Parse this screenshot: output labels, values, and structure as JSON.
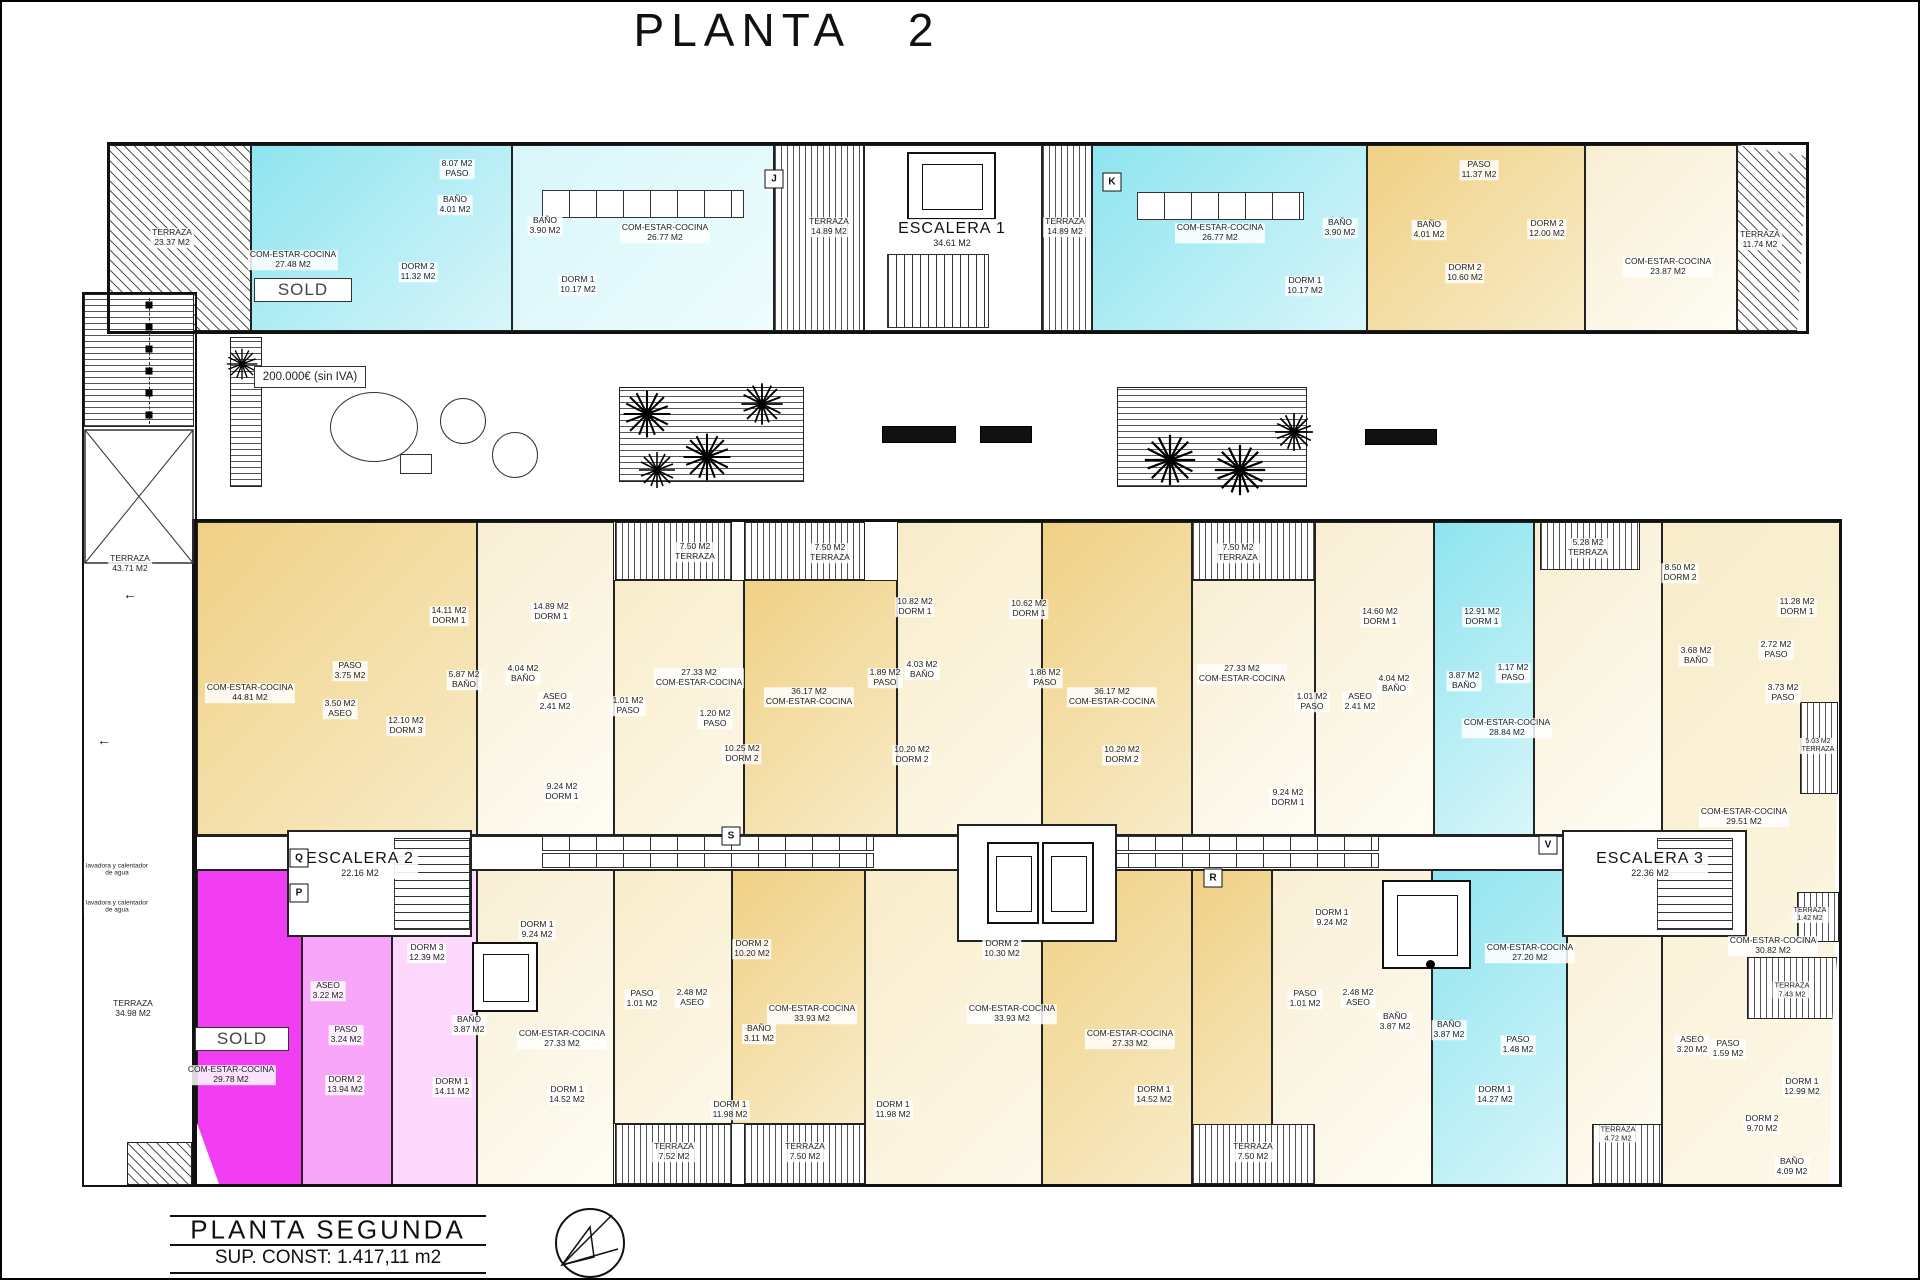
{
  "title": "PLANTA   2",
  "price": "200.000€ (sin IVA)",
  "sold": "SOLD",
  "footer": {
    "name": "PLANTA SEGUNDA",
    "sup": "SUP. CONST: 1.417,11 m2"
  },
  "colors": {
    "cyan": "#8ee4ef",
    "cyanLight": "#d8f6fa",
    "yellow": "#f0d084",
    "yellowLight": "#f8ecc9",
    "magenta": "#f23ef2",
    "pink": "#f8a6f8",
    "pinkLight": "#fcd9fc",
    "wall": "#111111",
    "hatch": "#555555"
  },
  "stairs": [
    {
      "name": "ESCALERA 1",
      "area": "34.61 M2",
      "x": 950,
      "y": 232
    },
    {
      "name": "ESCALERA 2",
      "area": "22.16 M2",
      "x": 358,
      "y": 862
    },
    {
      "name": "ESCALERA 3",
      "area": "22.36 M2",
      "x": 1648,
      "y": 862
    }
  ],
  "markers": [
    {
      "t": "J",
      "x": 772,
      "y": 177
    },
    {
      "t": "K",
      "x": 1110,
      "y": 180
    },
    {
      "t": "Q",
      "x": 297,
      "y": 856
    },
    {
      "t": "P",
      "x": 297,
      "y": 891
    },
    {
      "t": "S",
      "x": 729,
      "y": 834
    },
    {
      "t": "R",
      "x": 1211,
      "y": 876
    },
    {
      "t": "V",
      "x": 1546,
      "y": 843
    }
  ],
  "decor_glyphs": [
    {
      "t": "←",
      "x": 102,
      "y": 738
    },
    {
      "t": "←",
      "x": 128,
      "y": 592
    }
  ],
  "rooms": [
    {
      "lines": [
        "TERRAZA",
        "23.37 M2"
      ],
      "x": 170,
      "y": 236
    },
    {
      "lines": [
        "8.07 M2",
        "PASO"
      ],
      "x": 455,
      "y": 167
    },
    {
      "lines": [
        "BAÑO",
        "4.01 M2"
      ],
      "x": 453,
      "y": 203
    },
    {
      "lines": [
        "COM-ESTAR-COCINA",
        "27.48 M2"
      ],
      "x": 291,
      "y": 258
    },
    {
      "lines": [
        "DORM 2",
        "11.32 M2"
      ],
      "x": 416,
      "y": 270
    },
    {
      "lines": [
        "BAÑO",
        "3.90 M2"
      ],
      "x": 543,
      "y": 224
    },
    {
      "lines": [
        "DORM 1",
        "10.17 M2"
      ],
      "x": 576,
      "y": 283
    },
    {
      "lines": [
        "COM-ESTAR-COCINA",
        "26.77 M2"
      ],
      "x": 663,
      "y": 231
    },
    {
      "lines": [
        "TERRAZA",
        "14.89 M2"
      ],
      "x": 827,
      "y": 225
    },
    {
      "lines": [
        "TERRAZA",
        "14.89 M2"
      ],
      "x": 1063,
      "y": 225
    },
    {
      "lines": [
        "COM-ESTAR-COCINA",
        "26.77 M2"
      ],
      "x": 1218,
      "y": 231
    },
    {
      "lines": [
        "BAÑO",
        "3.90 M2"
      ],
      "x": 1338,
      "y": 226
    },
    {
      "lines": [
        "DORM 1",
        "10.17 M2"
      ],
      "x": 1303,
      "y": 284
    },
    {
      "lines": [
        "PASO",
        "11.37 M2"
      ],
      "x": 1477,
      "y": 168
    },
    {
      "lines": [
        "BAÑO",
        "4.01 M2"
      ],
      "x": 1427,
      "y": 228
    },
    {
      "lines": [
        "DORM 2",
        "10.60 M2"
      ],
      "x": 1463,
      "y": 271
    },
    {
      "lines": [
        "DORM 2",
        "12.00 M2"
      ],
      "x": 1545,
      "y": 227
    },
    {
      "lines": [
        "COM-ESTAR-COCINA",
        "23.87 M2"
      ],
      "x": 1666,
      "y": 265
    },
    {
      "lines": [
        "TERRAZA",
        "11.74 M2"
      ],
      "x": 1758,
      "y": 238
    },
    {
      "lines": [
        "TERRAZA",
        "43.71 M2"
      ],
      "x": 128,
      "y": 562
    },
    {
      "lines": [
        "lavadora y calentador",
        "de agua"
      ],
      "x": 115,
      "y": 868,
      "fs": 6.5
    },
    {
      "lines": [
        "lavadora y calentador",
        "de agua"
      ],
      "x": 115,
      "y": 905,
      "fs": 6.5
    },
    {
      "lines": [
        "TERRAZA",
        "34.98 M2"
      ],
      "x": 131,
      "y": 1007
    },
    {
      "lines": [
        "14.11 M2",
        "DORM 1"
      ],
      "x": 447,
      "y": 614
    },
    {
      "lines": [
        "14.89 M2",
        "DORM 1"
      ],
      "x": 549,
      "y": 610
    },
    {
      "lines": [
        "COM-ESTAR-COCINA",
        "44.81 M2"
      ],
      "x": 248,
      "y": 691
    },
    {
      "lines": [
        "PASO",
        "3.75 M2"
      ],
      "x": 348,
      "y": 669
    },
    {
      "lines": [
        "3.50 M2",
        "ASEO"
      ],
      "x": 338,
      "y": 707
    },
    {
      "lines": [
        "5.87 M2",
        "BAÑO"
      ],
      "x": 462,
      "y": 678
    },
    {
      "lines": [
        "12.10 M2",
        "DORM 3"
      ],
      "x": 404,
      "y": 724
    },
    {
      "lines": [
        "4.04 M2",
        "BAÑO"
      ],
      "x": 521,
      "y": 672
    },
    {
      "lines": [
        "ASEO",
        "2.41 M2"
      ],
      "x": 553,
      "y": 700
    },
    {
      "lines": [
        "1.01 M2",
        "PASO"
      ],
      "x": 626,
      "y": 704
    },
    {
      "lines": [
        "27.33 M2",
        "COM-ESTAR-COCINA"
      ],
      "x": 697,
      "y": 676
    },
    {
      "lines": [
        "7.50 M2",
        "TERRAZA"
      ],
      "x": 693,
      "y": 550
    },
    {
      "lines": [
        "7.50 M2",
        "TERRAZA"
      ],
      "x": 828,
      "y": 551
    },
    {
      "lines": [
        "36.17 M2",
        "COM-ESTAR-COCINA"
      ],
      "x": 807,
      "y": 695
    },
    {
      "lines": [
        "1.20 M2",
        "PASO"
      ],
      "x": 713,
      "y": 717
    },
    {
      "lines": [
        "10.25 M2",
        "DORM 2"
      ],
      "x": 740,
      "y": 752
    },
    {
      "lines": [
        "10.82 M2",
        "DORM 1"
      ],
      "x": 913,
      "y": 605
    },
    {
      "lines": [
        "4.03 M2",
        "BAÑO"
      ],
      "x": 920,
      "y": 668
    },
    {
      "lines": [
        "1.89 M2",
        "PASO"
      ],
      "x": 883,
      "y": 676
    },
    {
      "lines": [
        "10.62 M2",
        "DORM 1"
      ],
      "x": 1027,
      "y": 607
    },
    {
      "lines": [
        "1.86 M2",
        "PASO"
      ],
      "x": 1043,
      "y": 676
    },
    {
      "lines": [
        "36.17 M2",
        "COM-ESTAR-COCINA"
      ],
      "x": 1110,
      "y": 695
    },
    {
      "lines": [
        "10.20 M2",
        "DORM 2"
      ],
      "x": 910,
      "y": 753
    },
    {
      "lines": [
        "10.20 M2",
        "DORM 2"
      ],
      "x": 1120,
      "y": 753
    },
    {
      "lines": [
        "27.33 M2",
        "COM-ESTAR-COCINA"
      ],
      "x": 1240,
      "y": 672
    },
    {
      "lines": [
        "1.01 M2",
        "PASO"
      ],
      "x": 1310,
      "y": 700
    },
    {
      "lines": [
        "9.24 M2",
        "DORM 1"
      ],
      "x": 560,
      "y": 790
    },
    {
      "lines": [
        "9.24 M2",
        "DORM 1"
      ],
      "x": 1286,
      "y": 796
    },
    {
      "lines": [
        "7.50 M2",
        "TERRAZA"
      ],
      "x": 1236,
      "y": 551
    },
    {
      "lines": [
        "14.60 M2",
        "DORM 1"
      ],
      "x": 1378,
      "y": 615
    },
    {
      "lines": [
        "4.04 M2",
        "BAÑO"
      ],
      "x": 1392,
      "y": 682
    },
    {
      "lines": [
        "ASEO",
        "2.41 M2"
      ],
      "x": 1358,
      "y": 700
    },
    {
      "lines": [
        "12.91 M2",
        "DORM 1"
      ],
      "x": 1480,
      "y": 615
    },
    {
      "lines": [
        "3.87 M2",
        "BAÑO"
      ],
      "x": 1462,
      "y": 679
    },
    {
      "lines": [
        "1.17 M2",
        "PASO"
      ],
      "x": 1511,
      "y": 671
    },
    {
      "lines": [
        "COM-ESTAR-COCINA",
        "28.84 M2"
      ],
      "x": 1505,
      "y": 726
    },
    {
      "lines": [
        "5.28 M2",
        "TERRAZA"
      ],
      "x": 1586,
      "y": 546
    },
    {
      "lines": [
        "8.50 M2",
        "DORM 2"
      ],
      "x": 1678,
      "y": 571
    },
    {
      "lines": [
        "11.28 M2",
        "DORM 1"
      ],
      "x": 1795,
      "y": 605
    },
    {
      "lines": [
        "3.68 M2",
        "BAÑO"
      ],
      "x": 1694,
      "y": 654
    },
    {
      "lines": [
        "2.72 M2",
        "PASO"
      ],
      "x": 1774,
      "y": 648
    },
    {
      "lines": [
        "3.73 M2",
        "PASO"
      ],
      "x": 1781,
      "y": 691
    },
    {
      "lines": [
        "COM-ESTAR-COCINA",
        "29.51 M2"
      ],
      "x": 1742,
      "y": 815
    },
    {
      "lines": [
        "5.03 M2",
        "TERRAZA"
      ],
      "x": 1816,
      "y": 744,
      "fs": 7
    },
    {
      "lines": [
        "DORM 3",
        "12.39 M2"
      ],
      "x": 425,
      "y": 951
    },
    {
      "lines": [
        "ASEO",
        "3.22 M2"
      ],
      "x": 326,
      "y": 989
    },
    {
      "lines": [
        "PASO",
        "3.24 M2"
      ],
      "x": 344,
      "y": 1033
    },
    {
      "lines": [
        "COM-ESTAR-COCINA",
        "29.78 M2"
      ],
      "x": 229,
      "y": 1073
    },
    {
      "lines": [
        "DORM 2",
        "13.94 M2"
      ],
      "x": 343,
      "y": 1083
    },
    {
      "lines": [
        "DORM 1",
        "14.11 M2"
      ],
      "x": 450,
      "y": 1085
    },
    {
      "lines": [
        "BAÑO",
        "3.87 M2"
      ],
      "x": 467,
      "y": 1023
    },
    {
      "lines": [
        "DORM 1",
        "9.24 M2"
      ],
      "x": 535,
      "y": 928
    },
    {
      "lines": [
        "2.48 M2",
        "ASEO"
      ],
      "x": 690,
      "y": 996
    },
    {
      "lines": [
        "PASO",
        "1.01 M2"
      ],
      "x": 640,
      "y": 997
    },
    {
      "lines": [
        "COM-ESTAR-COCINA",
        "27.33 M2"
      ],
      "x": 560,
      "y": 1037
    },
    {
      "lines": [
        "DORM 1",
        "14.52 M2"
      ],
      "x": 565,
      "y": 1093
    },
    {
      "lines": [
        "DORM 2",
        "10.20 M2"
      ],
      "x": 750,
      "y": 947
    },
    {
      "lines": [
        "DORM 2",
        "10.30 M2"
      ],
      "x": 1000,
      "y": 947
    },
    {
      "lines": [
        "COM-ESTAR-COCINA",
        "33.93 M2"
      ],
      "x": 810,
      "y": 1012
    },
    {
      "lines": [
        "COM-ESTAR-COCINA",
        "33.93 M2"
      ],
      "x": 1010,
      "y": 1012
    },
    {
      "lines": [
        "BAÑO",
        "3.11 M2"
      ],
      "x": 757,
      "y": 1032
    },
    {
      "lines": [
        "DORM 1",
        "11.98 M2"
      ],
      "x": 728,
      "y": 1108
    },
    {
      "lines": [
        "DORM 1",
        "11.98 M2"
      ],
      "x": 891,
      "y": 1108
    },
    {
      "lines": [
        "DORM 1",
        "9.24 M2"
      ],
      "x": 1330,
      "y": 916
    },
    {
      "lines": [
        "2.48 M2",
        "ASEO"
      ],
      "x": 1356,
      "y": 996
    },
    {
      "lines": [
        "PASO",
        "1.01 M2"
      ],
      "x": 1303,
      "y": 997
    },
    {
      "lines": [
        "BAÑO",
        "3.87 M2"
      ],
      "x": 1393,
      "y": 1020
    },
    {
      "lines": [
        "COM-ESTAR-COCINA",
        "27.33 M2"
      ],
      "x": 1128,
      "y": 1037
    },
    {
      "lines": [
        "DORM 1",
        "14.52 M2"
      ],
      "x": 1152,
      "y": 1093
    },
    {
      "lines": [
        "COM-ESTAR-COCINA",
        "27.20 M2"
      ],
      "x": 1528,
      "y": 951
    },
    {
      "lines": [
        "DORM 1",
        "14.27 M2"
      ],
      "x": 1493,
      "y": 1093
    },
    {
      "lines": [
        "PASO",
        "1.48 M2"
      ],
      "x": 1516,
      "y": 1043
    },
    {
      "lines": [
        "BAÑO",
        "3.87 M2"
      ],
      "x": 1447,
      "y": 1028
    },
    {
      "lines": [
        "TERRAZA",
        "4.72 M2"
      ],
      "x": 1616,
      "y": 1132,
      "fs": 7.5
    },
    {
      "lines": [
        "COM-ESTAR-COCINA",
        "30.82 M2"
      ],
      "x": 1771,
      "y": 944
    },
    {
      "lines": [
        "TERRAZA",
        "1.42 M2"
      ],
      "x": 1808,
      "y": 913,
      "fs": 7
    },
    {
      "lines": [
        "ASEO",
        "3.20 M2"
      ],
      "x": 1690,
      "y": 1043
    },
    {
      "lines": [
        "PASO",
        "1.59 M2"
      ],
      "x": 1726,
      "y": 1047
    },
    {
      "lines": [
        "DORM 1",
        "12.99 M2"
      ],
      "x": 1800,
      "y": 1085
    },
    {
      "lines": [
        "DORM 2",
        "9.70 M2"
      ],
      "x": 1760,
      "y": 1122
    },
    {
      "lines": [
        "BAÑO",
        "4.09 M2"
      ],
      "x": 1790,
      "y": 1165
    },
    {
      "lines": [
        "TERRAZA",
        "7.43 M2"
      ],
      "x": 1790,
      "y": 988,
      "fs": 7.5
    },
    {
      "lines": [
        "TERRAZA",
        "7.52 M2"
      ],
      "x": 672,
      "y": 1150
    },
    {
      "lines": [
        "TERRAZA",
        "7.50 M2"
      ],
      "x": 803,
      "y": 1150
    },
    {
      "lines": [
        "TERRAZA",
        "7.50 M2"
      ],
      "x": 1251,
      "y": 1150
    }
  ]
}
